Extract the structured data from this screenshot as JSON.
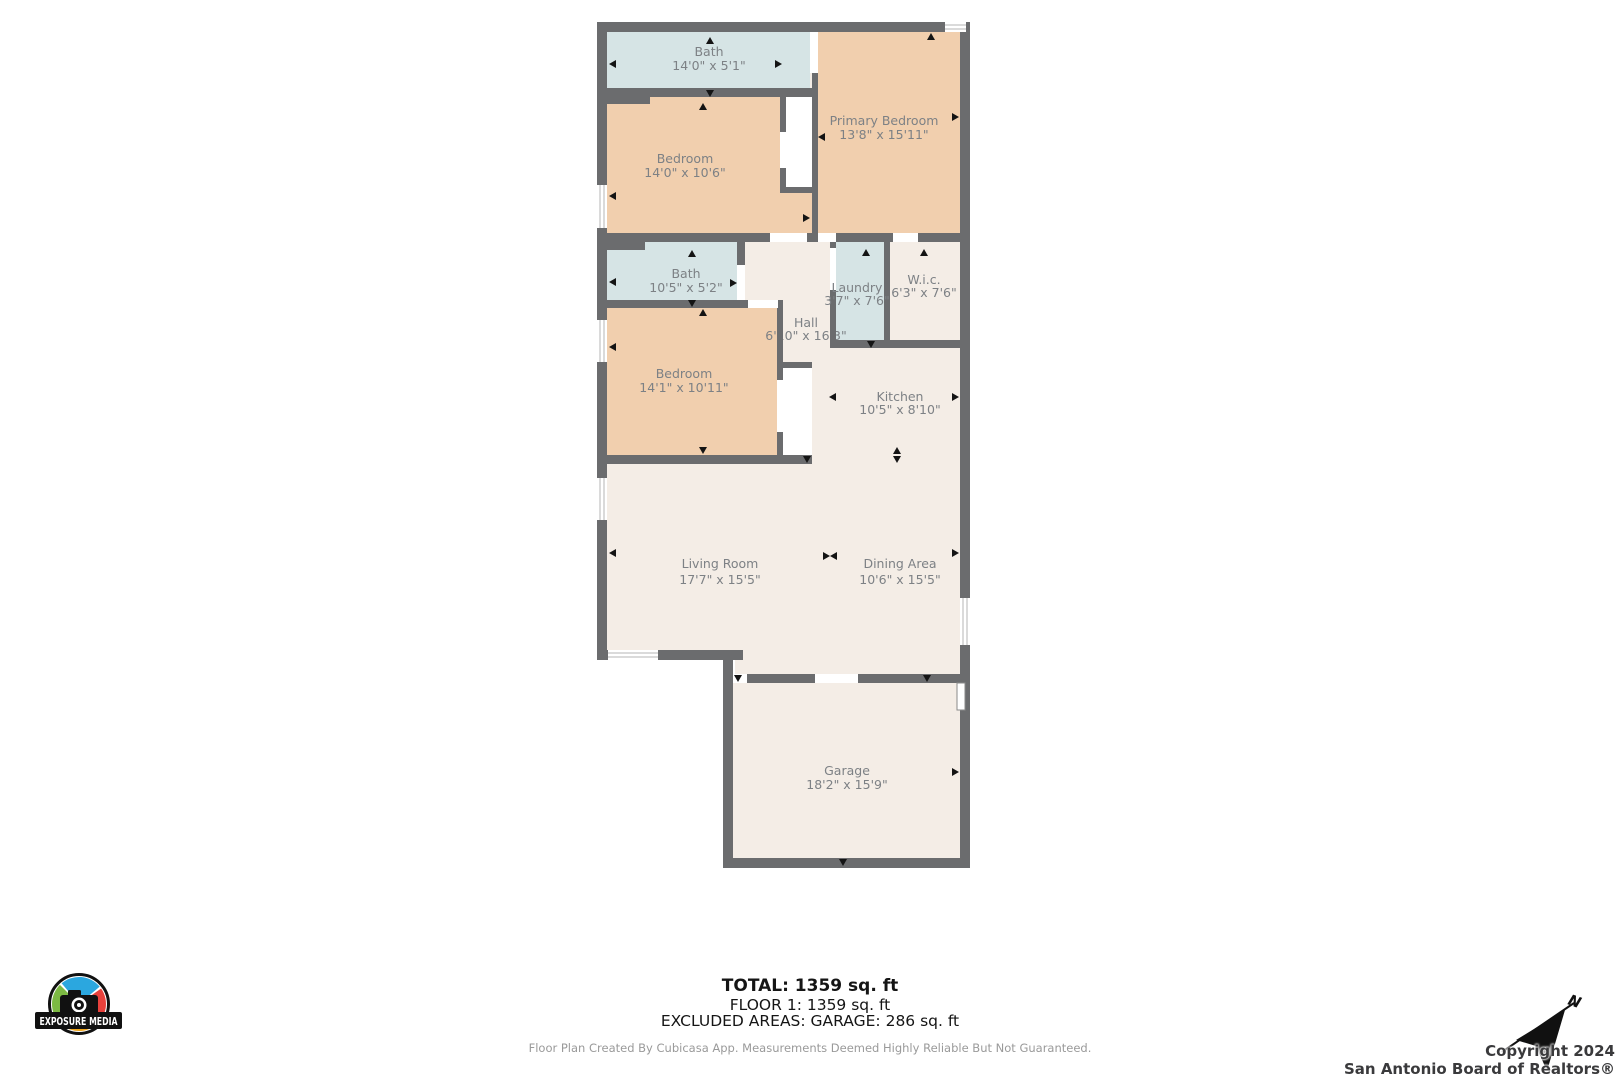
{
  "plan": {
    "rooms": [
      {
        "name": "Bath",
        "dims": "14'0\" x 5'1\""
      },
      {
        "name": "Primary Bedroom",
        "dims": "13'8\" x 15'11\""
      },
      {
        "name": "Bedroom",
        "dims": "14'0\" x 10'6\""
      },
      {
        "name": "Bath",
        "dims": "10'5\" x 5'2\""
      },
      {
        "name": "Laundry",
        "dims": "3'7\" x 7'6\""
      },
      {
        "name": "W.i.c.",
        "dims": "6'3\" x 7'6\""
      },
      {
        "name": "Hall",
        "dims": "6'10\" x 16'3\""
      },
      {
        "name": "Bedroom",
        "dims": "14'1\" x 10'11\""
      },
      {
        "name": "Kitchen",
        "dims": "10'5\" x 8'10\""
      },
      {
        "name": "Living Room",
        "dims": "17'7\" x 15'5\""
      },
      {
        "name": "Dining Area",
        "dims": "10'6\" x 15'5\""
      },
      {
        "name": "Garage",
        "dims": "18'2\" x 15'9\""
      }
    ],
    "colors": {
      "wall": "#6b6c6e",
      "bedroom_fill": "#f1cfae",
      "wet_area_fill": "#d6e4e5",
      "floor_fill": "#f4ede6",
      "label_text": "#7d8185"
    }
  },
  "summary": {
    "total": "TOTAL: 1359 sq. ft",
    "floor1": "FLOOR 1: 1359 sq. ft",
    "excluded": "EXCLUDED AREAS: GARAGE: 286 sq. ft"
  },
  "disclaimer": "Floor Plan Created By Cubicasa App. Measurements Deemed Highly Reliable But Not Guaranteed.",
  "logo": {
    "text": "EXPOSURE MEDIA"
  },
  "compass": {
    "label": "N"
  },
  "copyright": {
    "line1": "Copyright 2024",
    "line2": "San Antonio Board of Realtors®"
  }
}
